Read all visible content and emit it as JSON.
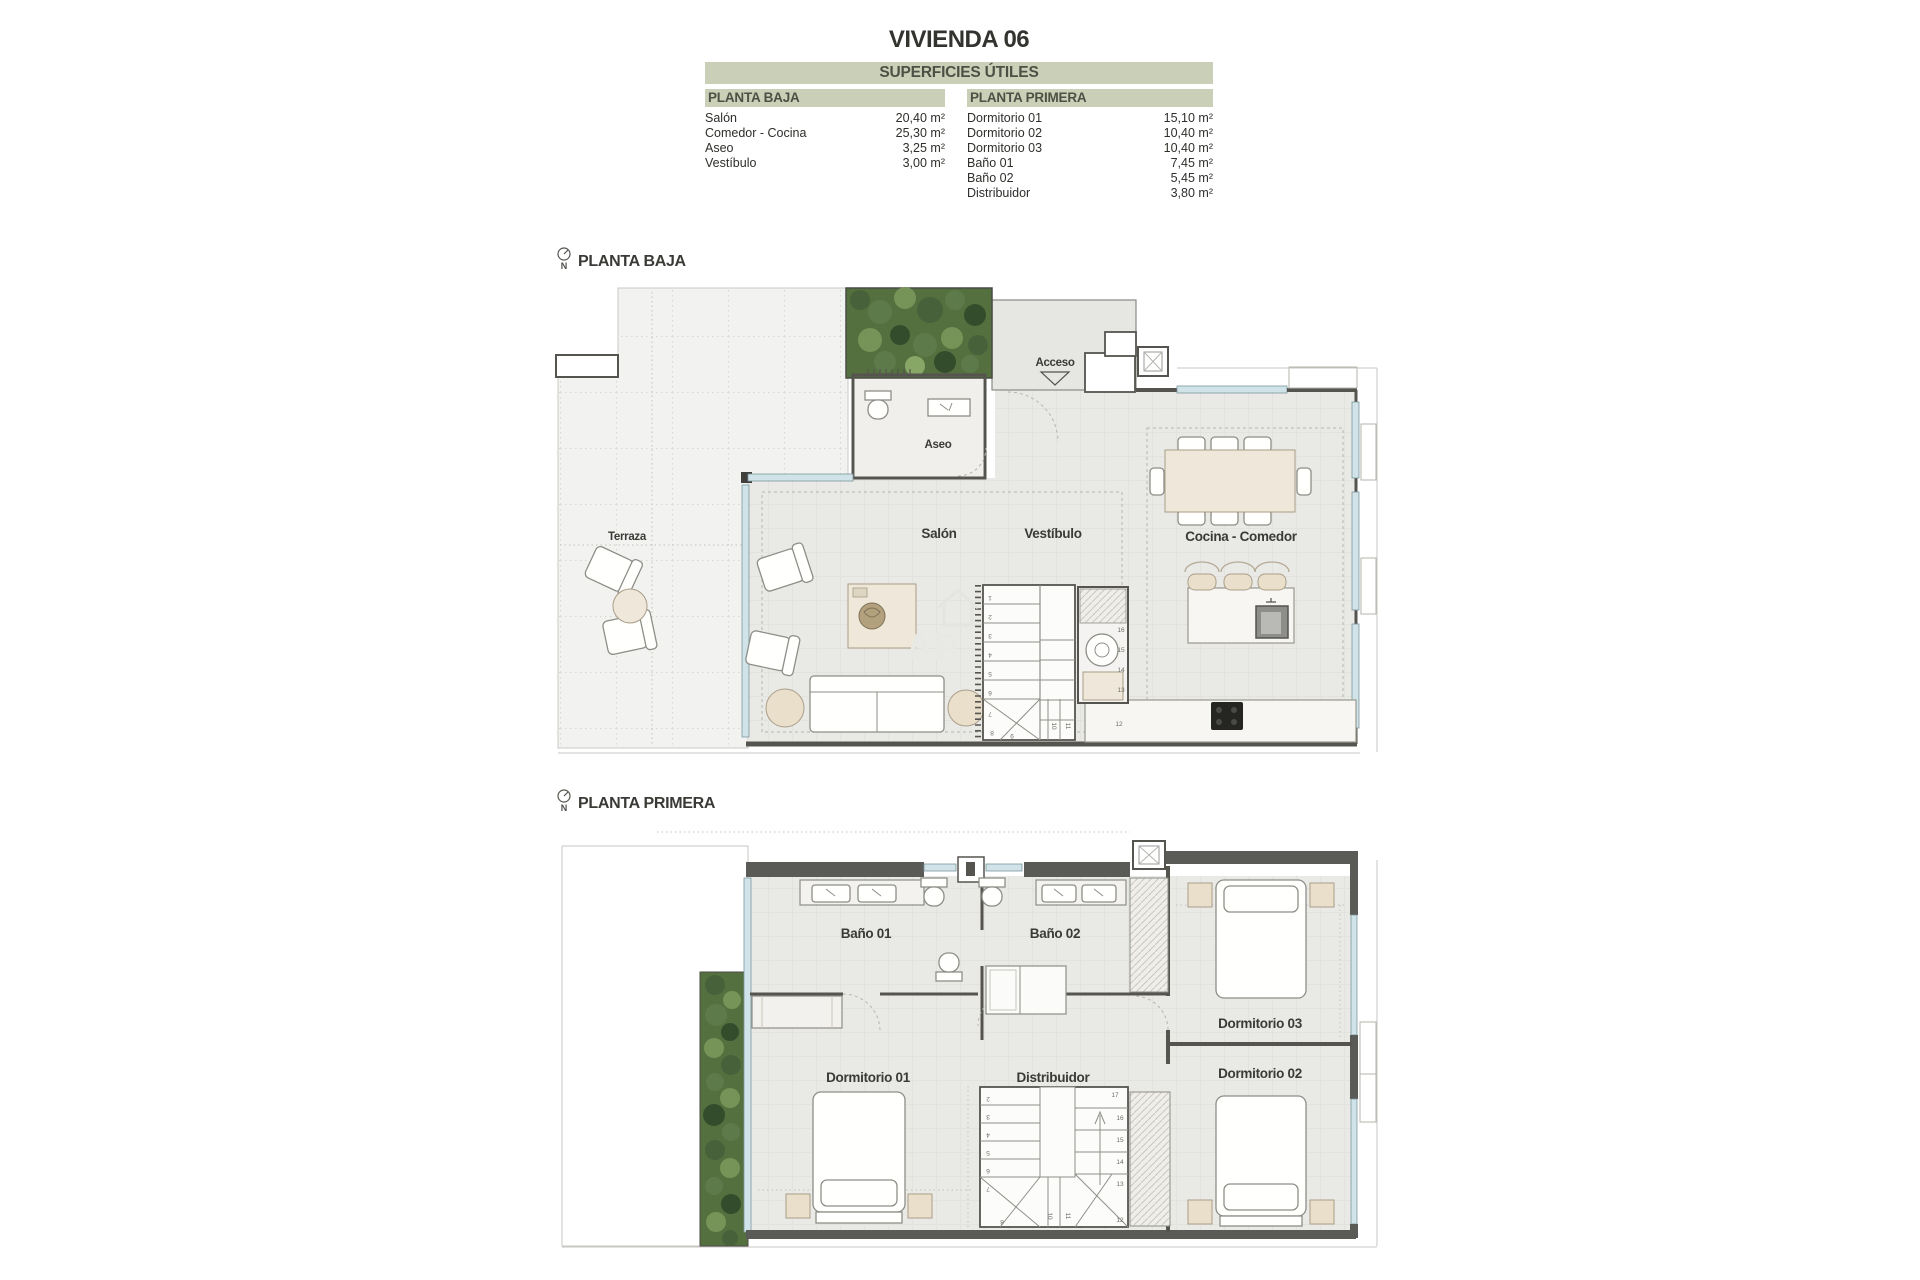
{
  "title": "VIVIENDA 06",
  "surfaces": {
    "header": "SUPERFICIES ÚTILES",
    "planta_baja": {
      "label": "PLANTA BAJA",
      "rows": [
        {
          "name": "Salón",
          "value": "20,40 m²"
        },
        {
          "name": "Comedor - Cocina",
          "value": "25,30 m²"
        },
        {
          "name": "Aseo",
          "value": "3,25 m²"
        },
        {
          "name": "Vestíbulo",
          "value": "3,00 m²"
        }
      ]
    },
    "planta_primera": {
      "label": "PLANTA PRIMERA",
      "rows": [
        {
          "name": "Dormitorio 01",
          "value": "15,10 m²"
        },
        {
          "name": "Dormitorio 02",
          "value": "10,40 m²"
        },
        {
          "name": "Dormitorio 03",
          "value": "10,40 m²"
        },
        {
          "name": "Baño 01",
          "value": "7,45 m²"
        },
        {
          "name": "Baño 02",
          "value": "5,45 m²"
        },
        {
          "name": "Distribuidor",
          "value": "3,80 m²"
        }
      ]
    }
  },
  "ground_plan": {
    "label": "PLANTA BAJA",
    "north": "N",
    "rooms": {
      "terraza": "Terraza",
      "aseo": "Aseo",
      "salon": "Salón",
      "vestibulo": "Vestíbulo",
      "cocina": "Cocina - Comedor"
    },
    "access": "Acceso",
    "stair_steps": [
      "1",
      "2",
      "3",
      "4",
      "5",
      "6",
      "7",
      "8",
      "9",
      "10",
      "11",
      "12",
      "13",
      "14",
      "15",
      "16"
    ]
  },
  "first_plan": {
    "label": "PLANTA PRIMERA",
    "north": "N",
    "rooms": {
      "bano1": "Baño 01",
      "bano2": "Baño 02",
      "dorm1": "Dormitorio 01",
      "dorm2": "Dormitorio 02",
      "dorm3": "Dormitorio 03",
      "distribuidor": "Distribuidor"
    },
    "stair_steps": [
      "2",
      "3",
      "4",
      "5",
      "6",
      "7",
      "8",
      "10",
      "11",
      "12",
      "13",
      "14",
      "15",
      "16",
      "17"
    ]
  },
  "watermark": {
    "text": "AP"
  },
  "colors": {
    "table_header_bg": "#c9d0b7",
    "table_header_text": "#4d5044",
    "wall": "#55544f",
    "window": "#cfe3e8",
    "terrace_floor": "#f2f2f0",
    "interior_floor": "#e9e9e6",
    "plant_green": "#55703f",
    "accent_beige": "#eadfcb"
  }
}
